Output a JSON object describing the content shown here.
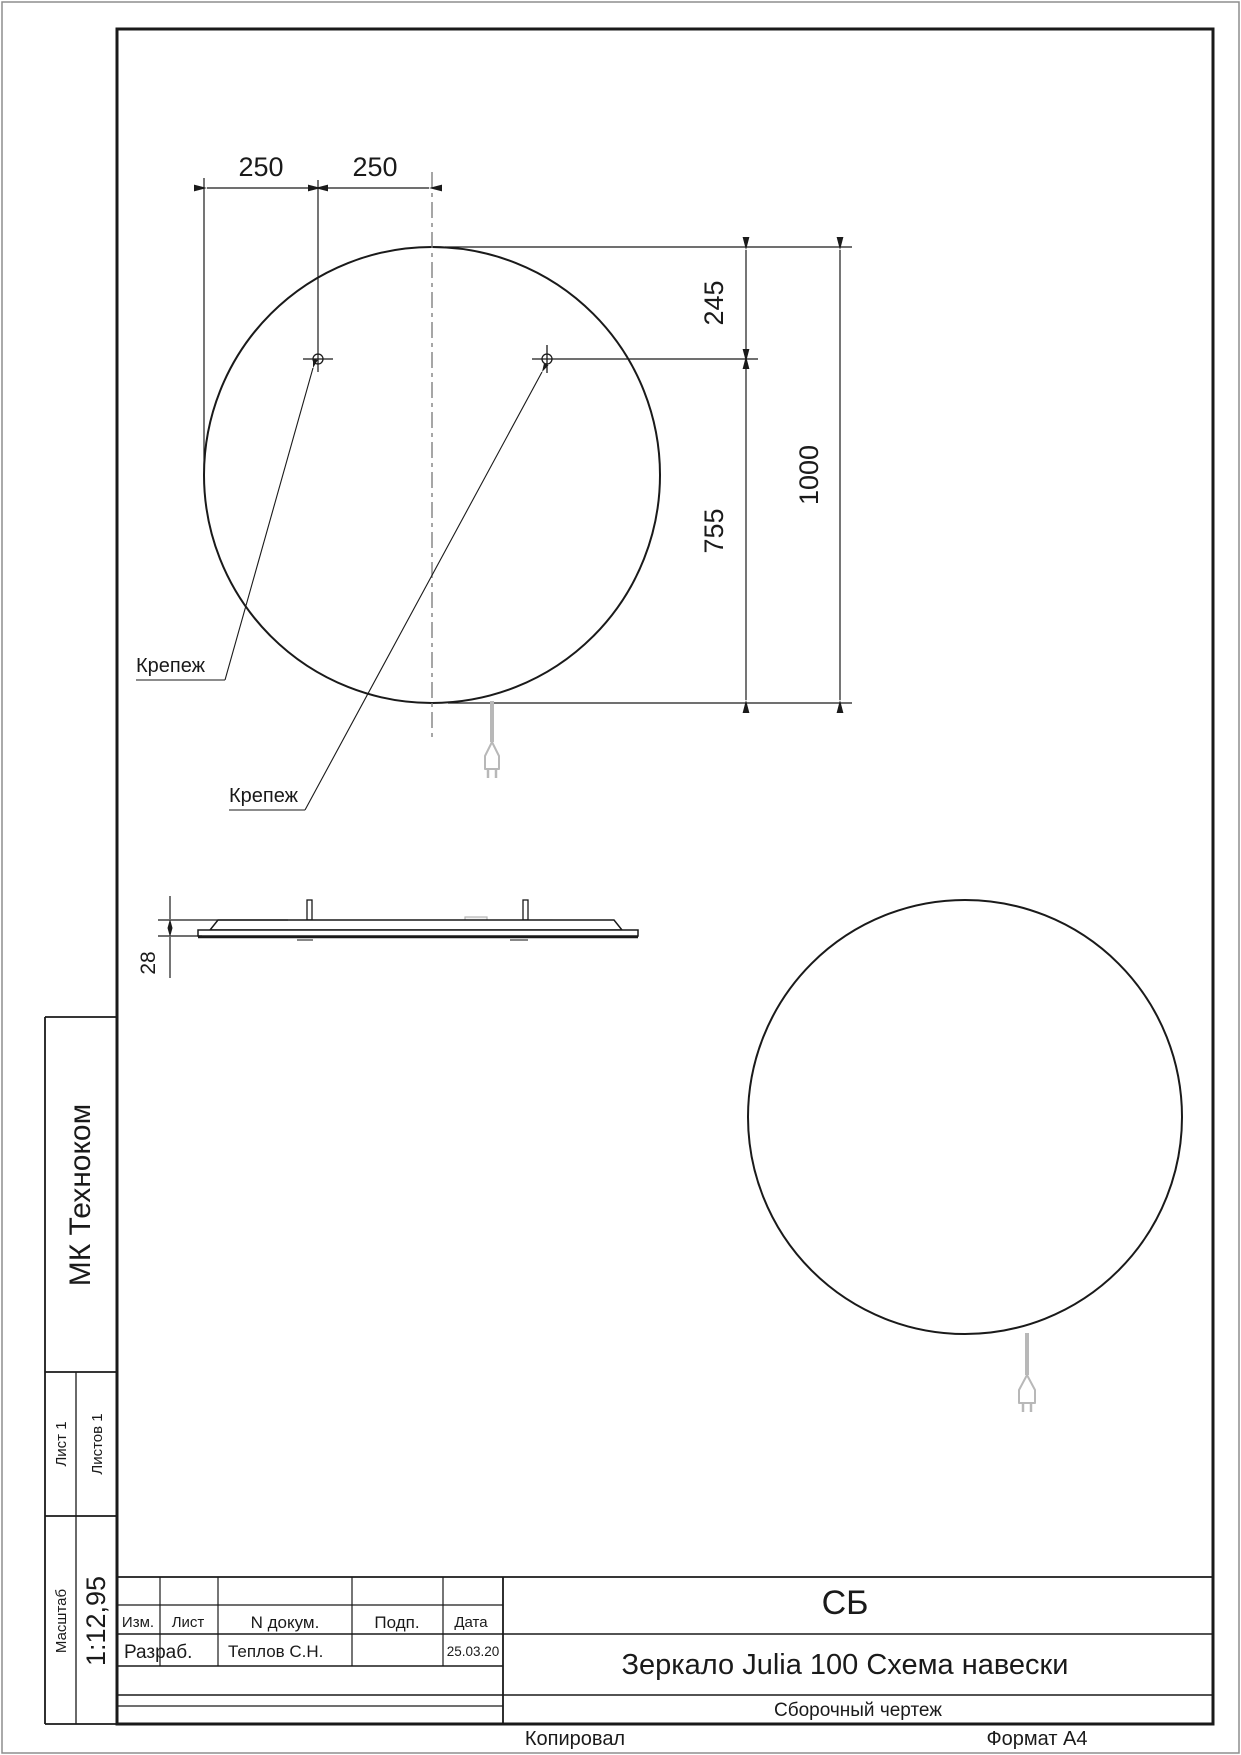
{
  "drawing": {
    "dims": {
      "d250_left": "250",
      "d250_right": "250",
      "d245": "245",
      "d755": "755",
      "d1000": "1000",
      "d28": "28"
    },
    "labels": {
      "fastener1": "Крепеж",
      "fastener2": "Крепеж"
    }
  },
  "sidebar": {
    "company": "МК Техноком",
    "sheet": "Лист 1",
    "sheets": "Листов 1",
    "scale_label": "Масштаб",
    "scale_value": "1:12,95"
  },
  "title_block": {
    "headers": {
      "izm": "Изм.",
      "list": "Лист",
      "ndoc": "N докум.",
      "podp": "Подп.",
      "data": "Дата"
    },
    "rows": {
      "role": "Разраб.",
      "name": "Теплов С.Н.",
      "date": "25.03.20"
    },
    "doc_type": "СБ",
    "title": "Зеркало Julia 100 Схема навески",
    "subtitle": "Сборочный чертеж"
  },
  "footer": {
    "copied": "Копировал",
    "format": "Формат А4"
  }
}
